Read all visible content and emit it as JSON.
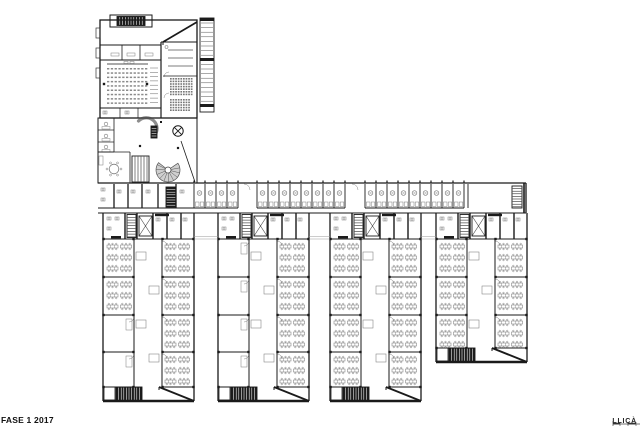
{
  "footer": {
    "phase_label": "FASE 1 2017",
    "project_label": "LLIÇÀ"
  },
  "plan": {
    "colors": {
      "wall": "#1a1a1a",
      "furniture": "#7d7d7d",
      "seat": "#8a8a8a",
      "core_fill": "#1c1c1c",
      "hatch_fill": "#cfcfcf",
      "light_line": "#9a9a9a",
      "background": "#ffffff"
    },
    "bar": {
      "left": 98,
      "right": 526,
      "top": 183,
      "cells_bottom": 208,
      "corridor_bottom": 213,
      "cell_width": 11,
      "cell_groups": [
        {
          "x": 194,
          "count": 4
        },
        {
          "x": 257,
          "count": 8
        },
        {
          "x": 365,
          "count": 9
        }
      ],
      "open_room": {
        "x": 468,
        "w": 42
      },
      "end_stair": {
        "x": 512,
        "y": 186,
        "w": 10,
        "h": 22
      }
    },
    "wings": [
      {
        "x": 103,
        "bottom": 401,
        "left_desks": [
          1,
          1,
          0,
          0
        ],
        "short": false
      },
      {
        "x": 218,
        "bottom": 401,
        "left_desks": [
          0,
          0,
          0,
          0
        ],
        "short": false
      },
      {
        "x": 330,
        "bottom": 401,
        "left_desks": [
          1,
          1,
          1,
          1
        ],
        "short": false
      },
      {
        "x": 436,
        "bottom": 362,
        "left_desks": [
          1,
          1,
          1
        ],
        "short": true
      }
    ],
    "wing_width": 91,
    "wing_top": 213,
    "service_row_bottom": 239,
    "room_dividers_tall": [
      277,
      315,
      352
    ],
    "room_dividers_short": [
      277,
      315
    ],
    "entry_block": {
      "x": 100,
      "y": 20,
      "w": 97,
      "h": 98
    },
    "auditorium_seats": {
      "rows": 9,
      "cols": 11
    },
    "lobby": {
      "fan_cx": 168,
      "fan_cy": 170,
      "fan_r": 12,
      "elev_x": 178,
      "elev_y": 131,
      "elev_r": 5.2
    }
  }
}
